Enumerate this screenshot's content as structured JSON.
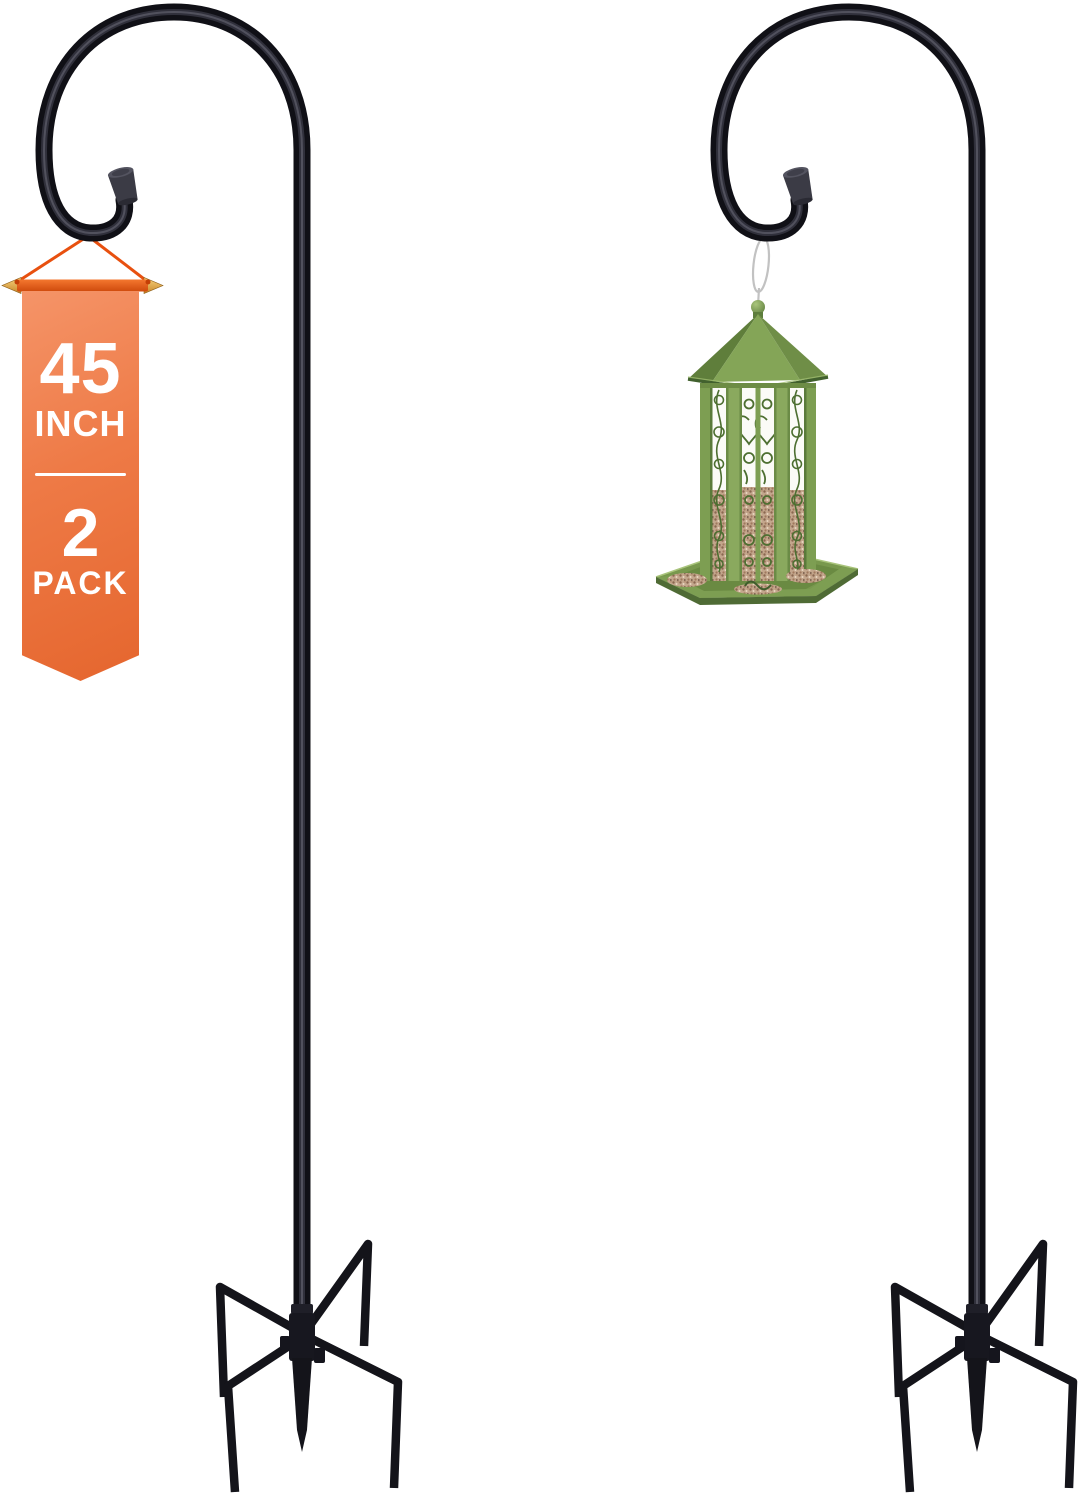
{
  "canvas": {
    "width": 1079,
    "height": 1500,
    "background": "#ffffff"
  },
  "badge": {
    "size_value": "45",
    "size_unit": "INCH",
    "pack_value": "2",
    "pack_unit": "PACK",
    "text_color": "#ffffff",
    "ribbon_color_top": "#f59468",
    "ribbon_color_bottom": "#e5662e",
    "hanger_bar_color": "#e2530f",
    "arrow_tip_color": "#dfa23a",
    "string_color": "#e8500f"
  },
  "products": {
    "left_hook": {
      "name": "shepherd-hook-45-inch",
      "color": "#101016",
      "cap_color": "#3b3b45"
    },
    "right_hook": {
      "name": "shepherd-hook-with-bird-feeder",
      "color": "#101016",
      "cap_color": "#3b3b45"
    },
    "base": {
      "name": "five-prong-ground-stake",
      "color": "#14141a"
    },
    "bird_feeder": {
      "name": "gazebo-bird-feeder",
      "roof_color": "#84a557",
      "body_color": "#8aa95e",
      "scrollwork_color": "#4d6f31",
      "seed_color": "#c3a68c",
      "tray_color": "#78984d",
      "hanger_wire_color": "#c2c2c2",
      "finial_color": "#6a8a44"
    }
  }
}
